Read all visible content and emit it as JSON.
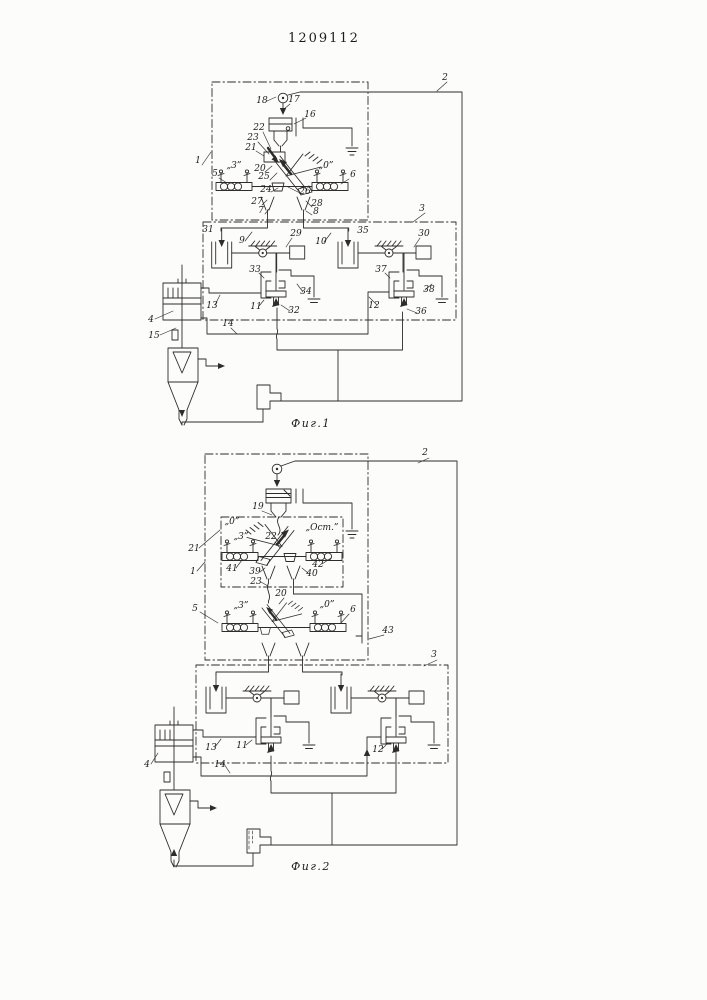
{
  "doc": {
    "patent_number": "1209112",
    "paper_color": "#fcfcfa",
    "ink_color": "#2e2c28"
  },
  "fig1": {
    "caption": "Фиг.1",
    "labels": [
      {
        "t": "1",
        "x": 198,
        "y": 163
      },
      {
        "t": "2",
        "x": 445,
        "y": 80
      },
      {
        "t": "3",
        "x": 422,
        "y": 211
      },
      {
        "t": "18",
        "x": 262,
        "y": 103
      },
      {
        "t": "17",
        "x": 294,
        "y": 102
      },
      {
        "t": "16",
        "x": 310,
        "y": 117
      },
      {
        "t": "22",
        "x": 259,
        "y": 130
      },
      {
        "t": "23",
        "x": 253,
        "y": 140
      },
      {
        "t": "21",
        "x": 251,
        "y": 150
      },
      {
        "t": "„3”",
        "x": 234,
        "y": 168
      },
      {
        "t": "5",
        "x": 215,
        "y": 176
      },
      {
        "t": "20",
        "x": 260,
        "y": 171
      },
      {
        "t": "25",
        "x": 264,
        "y": 179
      },
      {
        "t": "24",
        "x": 266,
        "y": 192
      },
      {
        "t": "26",
        "x": 305,
        "y": 194
      },
      {
        "t": "„0”",
        "x": 326,
        "y": 168
      },
      {
        "t": "6",
        "x": 353,
        "y": 177
      },
      {
        "t": "27",
        "x": 257,
        "y": 204
      },
      {
        "t": "7",
        "x": 261,
        "y": 213
      },
      {
        "t": "28",
        "x": 317,
        "y": 206
      },
      {
        "t": "8",
        "x": 316,
        "y": 214
      },
      {
        "t": "31",
        "x": 208,
        "y": 232
      },
      {
        "t": "9",
        "x": 242,
        "y": 243
      },
      {
        "t": "29",
        "x": 296,
        "y": 236
      },
      {
        "t": "10",
        "x": 321,
        "y": 244
      },
      {
        "t": "35",
        "x": 363,
        "y": 233
      },
      {
        "t": "30",
        "x": 424,
        "y": 236
      },
      {
        "t": "33",
        "x": 255,
        "y": 272
      },
      {
        "t": "34",
        "x": 306,
        "y": 294
      },
      {
        "t": "37",
        "x": 381,
        "y": 272
      },
      {
        "t": "38",
        "x": 429,
        "y": 292
      },
      {
        "t": "13",
        "x": 212,
        "y": 308
      },
      {
        "t": "11",
        "x": 256,
        "y": 309
      },
      {
        "t": "32",
        "x": 294,
        "y": 313
      },
      {
        "t": "12",
        "x": 374,
        "y": 308
      },
      {
        "t": "36",
        "x": 421,
        "y": 314
      },
      {
        "t": "14",
        "x": 228,
        "y": 326
      },
      {
        "t": "4",
        "x": 151,
        "y": 322
      },
      {
        "t": "15",
        "x": 154,
        "y": 338
      }
    ]
  },
  "fig2": {
    "caption": "Фиг.2",
    "labels": [
      {
        "t": "2",
        "x": 425,
        "y": 455
      },
      {
        "t": "1",
        "x": 193,
        "y": 574
      },
      {
        "t": "3",
        "x": 434,
        "y": 657
      },
      {
        "t": "19",
        "x": 258,
        "y": 509
      },
      {
        "t": "„0”",
        "x": 232,
        "y": 524
      },
      {
        "t": "„3”",
        "x": 241,
        "y": 539
      },
      {
        "t": "21",
        "x": 194,
        "y": 551
      },
      {
        "t": "22",
        "x": 271,
        "y": 539
      },
      {
        "t": "„Ост.”",
        "x": 322,
        "y": 530
      },
      {
        "t": "41",
        "x": 232,
        "y": 571
      },
      {
        "t": "42",
        "x": 318,
        "y": 567
      },
      {
        "t": "39",
        "x": 255,
        "y": 574
      },
      {
        "t": "40",
        "x": 312,
        "y": 576
      },
      {
        "t": "23",
        "x": 256,
        "y": 584
      },
      {
        "t": "20",
        "x": 281,
        "y": 596
      },
      {
        "t": "5",
        "x": 195,
        "y": 611
      },
      {
        "t": "„3”",
        "x": 241,
        "y": 608
      },
      {
        "t": "„0”",
        "x": 327,
        "y": 607
      },
      {
        "t": "6",
        "x": 353,
        "y": 612
      },
      {
        "t": "43",
        "x": 388,
        "y": 633
      },
      {
        "t": "13",
        "x": 211,
        "y": 750
      },
      {
        "t": "11",
        "x": 242,
        "y": 748
      },
      {
        "t": "12",
        "x": 378,
        "y": 752
      },
      {
        "t": "4",
        "x": 147,
        "y": 767
      },
      {
        "t": "14",
        "x": 220,
        "y": 767
      }
    ]
  }
}
